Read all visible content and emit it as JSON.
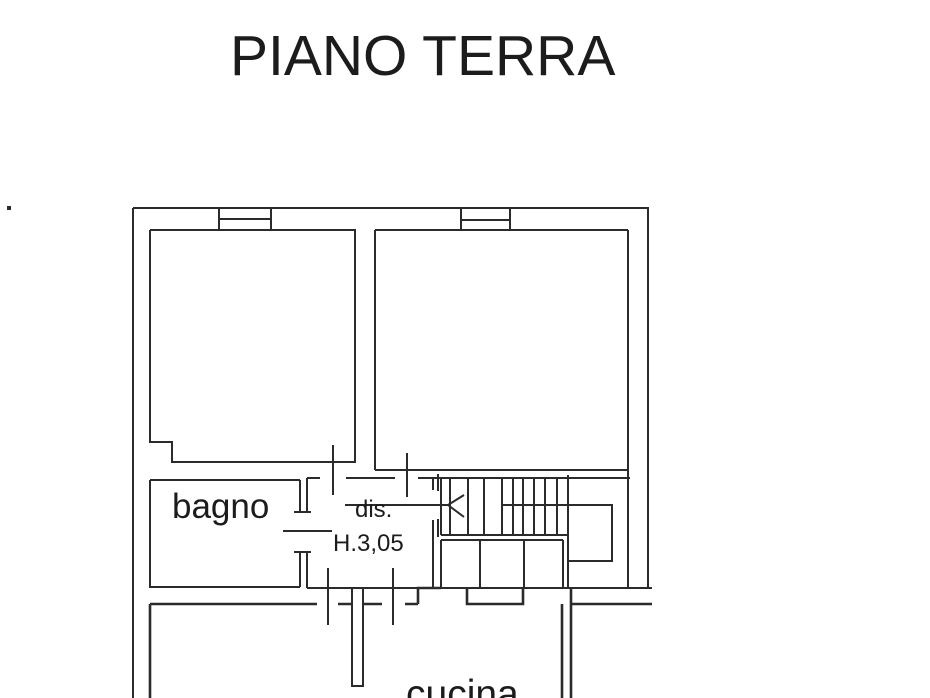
{
  "title": "PIANO TERRA",
  "rooms": {
    "bathroom": {
      "label": "bagno"
    },
    "hallway": {
      "label": "dis.",
      "height_annotation": "H.3,05"
    },
    "kitchen": {
      "label": "cucina"
    }
  },
  "colors": {
    "background": "#ffffff",
    "line": "#2b2b2b",
    "text": "#1c1c1c"
  }
}
